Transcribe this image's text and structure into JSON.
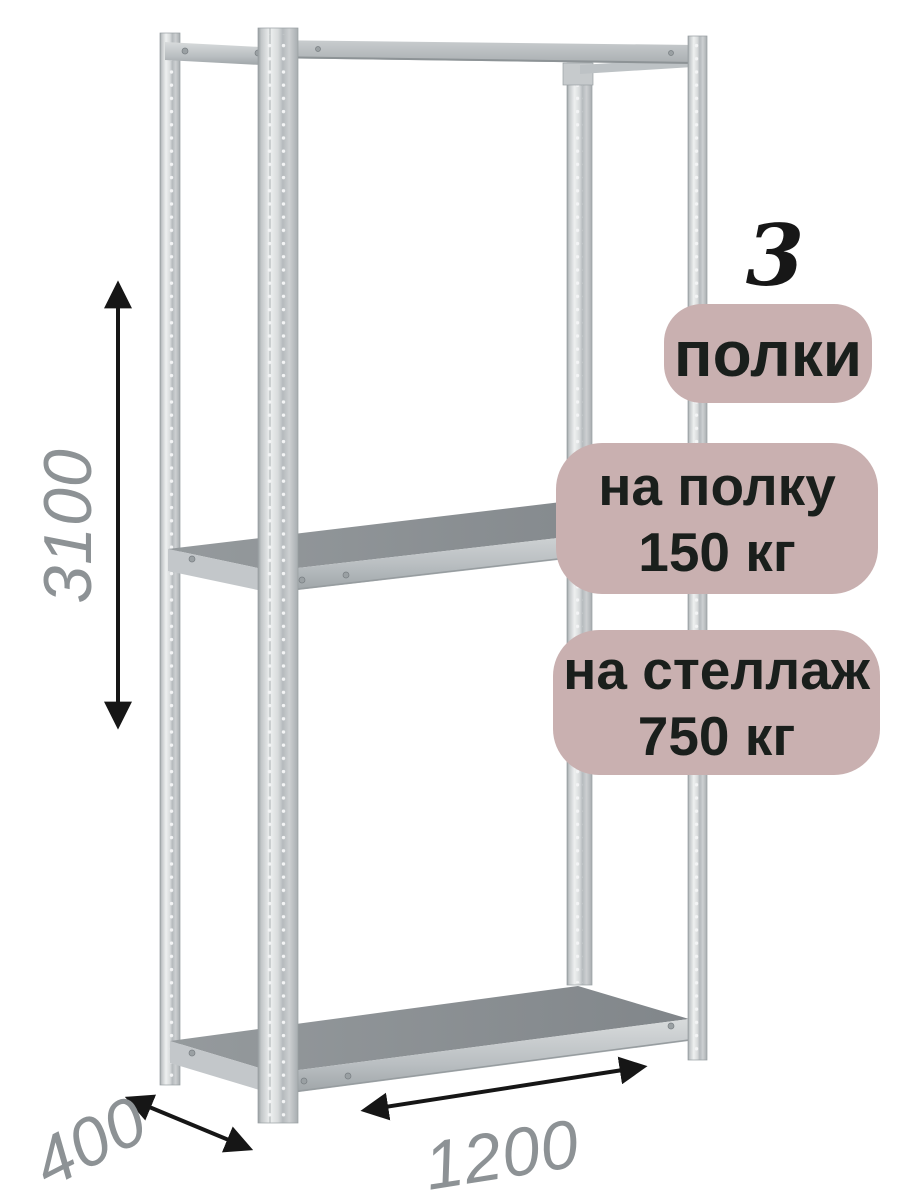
{
  "annotations": {
    "shelf_count": "3",
    "shelf_count_badge_label": "полки",
    "shelf_load_badge": {
      "line1": "на полку",
      "line2": "150 кг"
    },
    "rack_load_badge": {
      "line1": "на стеллаж",
      "line2": "750 кг"
    },
    "dimensions": {
      "height_mm": "3100",
      "depth_mm": "400",
      "width_mm": "1200"
    }
  },
  "colors": {
    "background": "#ffffff",
    "badge_background": "#c9b0b0",
    "badge_text": "#1a1f1c",
    "dimension_text": "#8d9295",
    "arrow": "#161616",
    "metal_light": "#e9ebec",
    "metal_mid": "#b5babd",
    "shelf_surface": "#8b9094"
  }
}
